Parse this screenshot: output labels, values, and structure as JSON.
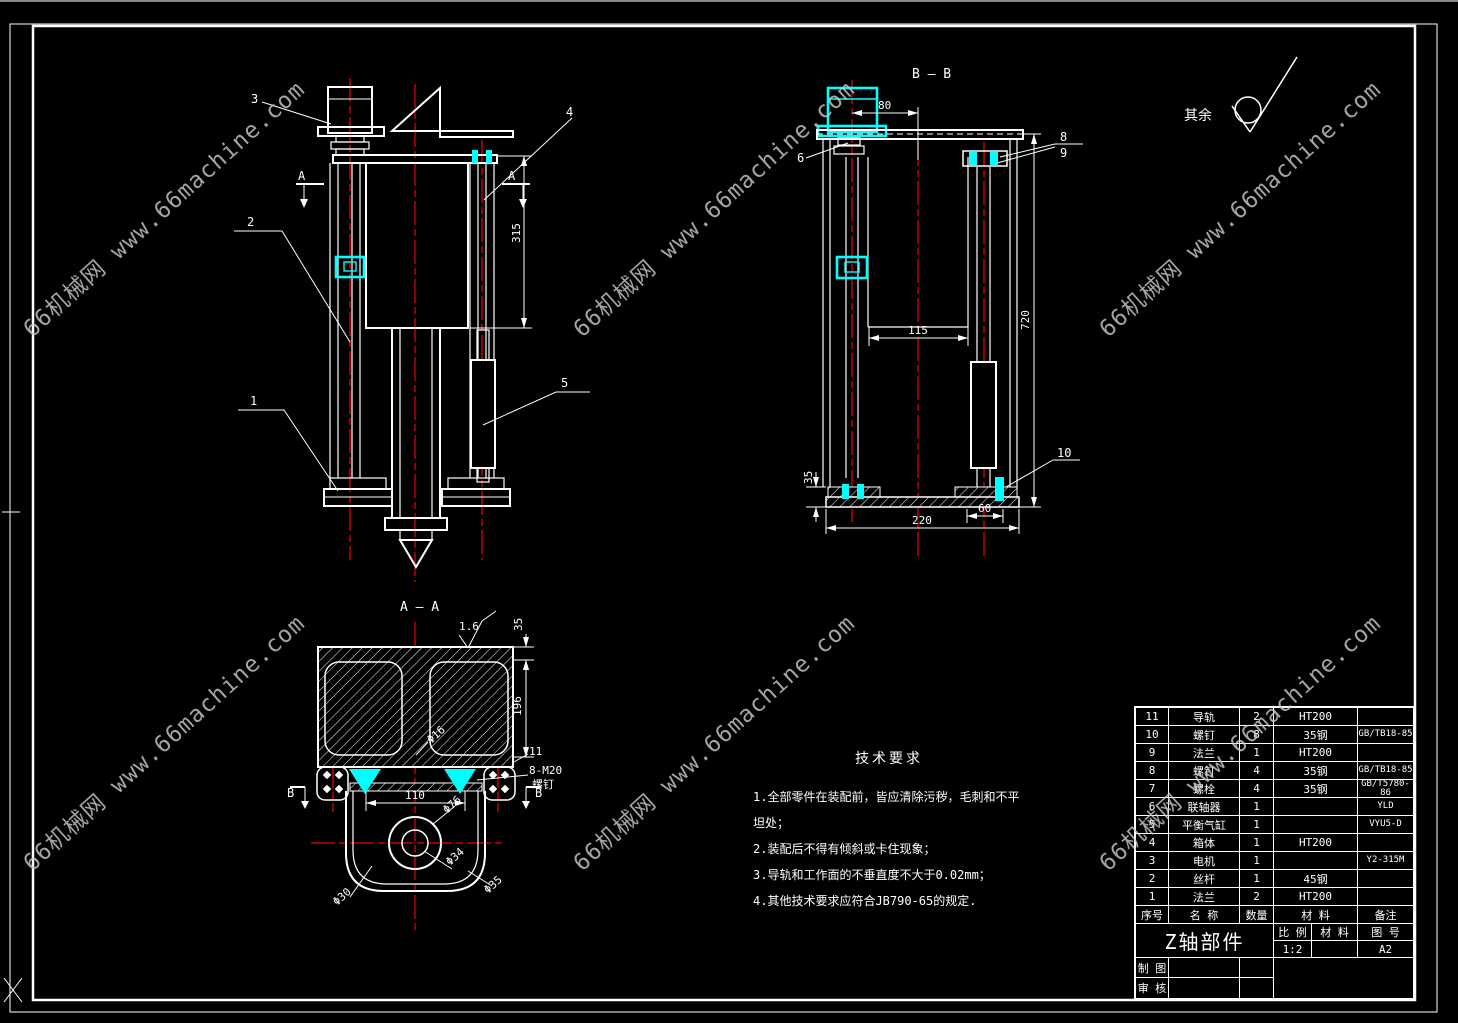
{
  "meta": {
    "background": "#000000",
    "line_color": "#ffffff",
    "centerline_color": "#f20000",
    "highlight_color": "#00ffff",
    "watermark_color": "#c8c8c8"
  },
  "watermark": {
    "text": "66机械网 www.66machine.com"
  },
  "finish_note": {
    "label": "其余"
  },
  "views": {
    "front": {
      "section_letter": "A",
      "balloons": {
        "b1": "1",
        "b2": "2",
        "b3": "3",
        "b4": "4",
        "b5": "5"
      },
      "dims": {
        "height": "315"
      }
    },
    "section_aa": {
      "title": "A — A",
      "roughness": "1.6",
      "section_letter": "B",
      "balloons": {
        "b11": "11"
      },
      "note_line1": "8-M20",
      "note_line2": "螺钉",
      "dims": {
        "top_thickness": "35",
        "depth": "196",
        "fillet": "Φ16",
        "bore_width": "110",
        "d76": "Φ76",
        "d34": "Φ34",
        "d35": "Φ35",
        "d30": "Φ30"
      }
    },
    "section_bb": {
      "title": "B — B",
      "balloons": {
        "b6": "6",
        "b8": "8",
        "b9": "9",
        "b10": "10"
      },
      "dims": {
        "offset": "80",
        "inner_width": "115",
        "height": "720",
        "plate": "35",
        "step": "60",
        "base_width": "220"
      }
    }
  },
  "tech_requirements": {
    "title": "技术要求",
    "lines": [
      "1.全部零件在装配前，皆应清除污秽，毛刺和不平坦处；",
      "2.装配后不得有倾斜或卡住现象；",
      "3.导轨和工作面的不垂直度不大于0.02mm；",
      "4.其他技术要求应符合JB790-65的规定."
    ]
  },
  "title_block": {
    "headers": {
      "no": "序号",
      "name": "名 称",
      "qty": "数量",
      "material": "材 料",
      "remark": "备注"
    },
    "rows": [
      {
        "no": "11",
        "name": "导轨",
        "qty": "2",
        "material": "HT200",
        "remark": ""
      },
      {
        "no": "10",
        "name": "螺钉",
        "qty": "8",
        "material": "35钢",
        "remark": "GB/TB18-85"
      },
      {
        "no": "9",
        "name": "法兰",
        "qty": "1",
        "material": "HT200",
        "remark": ""
      },
      {
        "no": "8",
        "name": "螺钉",
        "qty": "4",
        "material": "35钢",
        "remark": "GB/TB18-85"
      },
      {
        "no": "7",
        "name": "螺栓",
        "qty": "4",
        "material": "35钢",
        "remark": "GB/T5780-86"
      },
      {
        "no": "6",
        "name": "联轴器",
        "qty": "1",
        "material": "",
        "remark": "YLD"
      },
      {
        "no": "5",
        "name": "平衡气缸",
        "qty": "1",
        "material": "",
        "remark": "VYU5-D"
      },
      {
        "no": "4",
        "name": "箱体",
        "qty": "1",
        "material": "HT200",
        "remark": ""
      },
      {
        "no": "3",
        "name": "电机",
        "qty": "1",
        "material": "",
        "remark": "Y2-315M"
      },
      {
        "no": "2",
        "name": "丝杆",
        "qty": "1",
        "material": "45钢",
        "remark": ""
      },
      {
        "no": "1",
        "name": "法兰",
        "qty": "2",
        "material": "HT200",
        "remark": ""
      }
    ],
    "title": "Z轴部件",
    "scale_label": "比 例",
    "material_label": "材 料",
    "sheet_label": "图 号",
    "scale_value": "1:2",
    "sheet_value": "A2",
    "drafter_label": "制 图",
    "checker_label": "审 核"
  }
}
